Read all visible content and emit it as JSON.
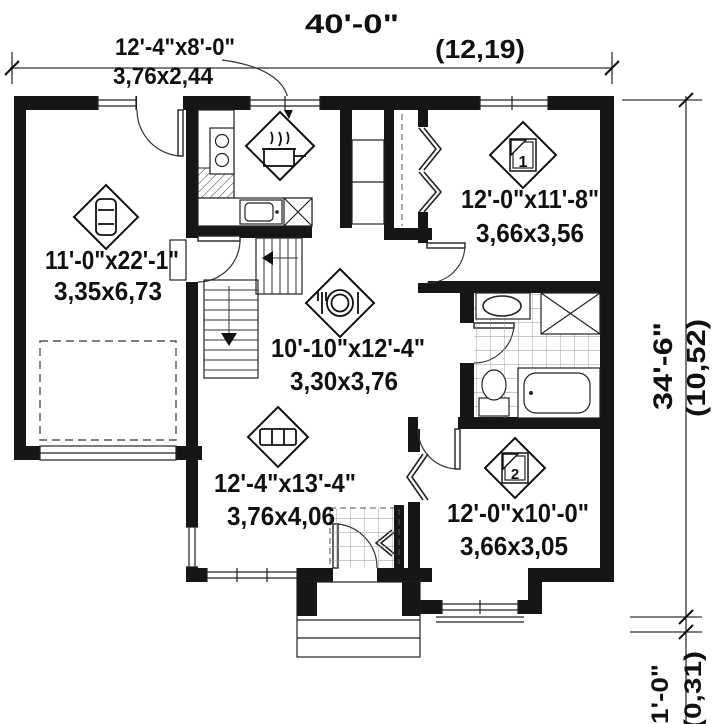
{
  "title": "Single-storey house floor plan",
  "overall_dimensions": {
    "width": {
      "imperial": "40'-0\"",
      "metric": "(12,19)"
    },
    "depth": {
      "imperial": "34'-6\"",
      "metric": "(10,52)"
    },
    "porch_step": {
      "imperial": "1'-0\"",
      "metric": "(0,31)"
    }
  },
  "rooms": {
    "kitchen": {
      "imperial": "12'-4\"x8'-0\"",
      "metric": "3,76x2,44"
    },
    "garage": {
      "imperial": "11'-0\"x22'-1\"",
      "metric": "3,35x6,73"
    },
    "bedroom1": {
      "number": "1",
      "imperial": "12'-0\"x11'-8\"",
      "metric": "3,66x3,56"
    },
    "dining": {
      "imperial": "10'-10\"x12'-4\"",
      "metric": "3,30x3,76"
    },
    "living": {
      "imperial": "12'-4\"x13'-4\"",
      "metric": "3,76x4,06"
    },
    "bedroom2": {
      "number": "2",
      "imperial": "12'-0\"x10'-0\"",
      "metric": "3,66x3,05"
    }
  },
  "icons": {
    "garage_marker": "car-icon",
    "kitchen_marker": "cooking-pot-icon",
    "dining_marker": "plate-and-cutlery-icon",
    "living_marker": "sofa-icon",
    "bedroom_markers": "bed-number-icon"
  },
  "colors": {
    "wall": "#161616",
    "line": "#333333",
    "background": "#ffffff"
  }
}
